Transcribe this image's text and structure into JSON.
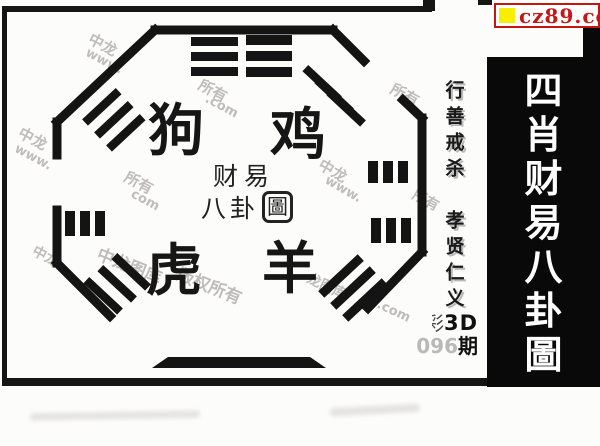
{
  "site_banner": {
    "text": "cz89.com",
    "accent_color": "#c41414",
    "square_color": "#f8ef00"
  },
  "right_strip": {
    "vertical_title": "四肖财易八卦圖",
    "chars": [
      "四",
      "肖",
      "财",
      "易",
      "八",
      "卦",
      "圖"
    ],
    "bg_color": "#090909",
    "text_color": "#ffffff"
  },
  "panel": {
    "zodiac": {
      "top_left": "狗",
      "top_right": "鸡",
      "bottom_left": "虎",
      "bottom_right": "羊"
    },
    "seal": {
      "line1": "财易",
      "line2_part1": "八卦",
      "line2_boxed": "圖"
    },
    "motto_line1": "行善戒杀",
    "motto_line2": "孝贤仁义",
    "issue": {
      "prefix_partial": "彩",
      "game": "3D",
      "number_faded": "096",
      "suffix": "期"
    }
  },
  "bagua_trigrams": [
    "top-left-corner",
    "top-center-left",
    "top-center-right",
    "top-right-corner",
    "left-side",
    "right-side-upper",
    "right-side-lower",
    "bottom-left-corner",
    "bottom-right-corner"
  ],
  "watermarks": [
    {
      "t": "中龙",
      "x": 88,
      "y": 34,
      "r": 28,
      "s": 15
    },
    {
      "t": "www.",
      "x": 84,
      "y": 54,
      "r": 28,
      "s": 13
    },
    {
      "t": "所有",
      "x": 198,
      "y": 80,
      "r": 28,
      "s": 15
    },
    {
      "t": ".com",
      "x": 204,
      "y": 99,
      "r": 28,
      "s": 13
    },
    {
      "t": "中龙",
      "x": 18,
      "y": 128,
      "r": 28,
      "s": 15
    },
    {
      "t": "www.",
      "x": 13,
      "y": 150,
      "r": 28,
      "s": 13
    },
    {
      "t": "所有",
      "x": 124,
      "y": 172,
      "r": 28,
      "s": 15
    },
    {
      "t": "com",
      "x": 130,
      "y": 193,
      "r": 28,
      "s": 13
    },
    {
      "t": "中龙",
      "x": 318,
      "y": 160,
      "r": 30,
      "s": 15
    },
    {
      "t": "www.",
      "x": 323,
      "y": 182,
      "r": 30,
      "s": 13
    },
    {
      "t": "所有",
      "x": 390,
      "y": 84,
      "r": 28,
      "s": 15
    },
    {
      "t": "所有",
      "x": 412,
      "y": 190,
      "r": 28,
      "s": 14
    },
    {
      "t": "中龙图库",
      "x": 96,
      "y": 252,
      "r": 22,
      "s": 17
    },
    {
      "t": "版权所有",
      "x": 176,
      "y": 272,
      "r": 22,
      "s": 17
    },
    {
      "t": "中龙",
      "x": 32,
      "y": 246,
      "r": 28,
      "s": 14
    },
    {
      "t": "龙图库",
      "x": 306,
      "y": 276,
      "r": 25,
      "s": 14
    },
    {
      "t": ".com",
      "x": 376,
      "y": 304,
      "r": 25,
      "s": 13
    }
  ]
}
